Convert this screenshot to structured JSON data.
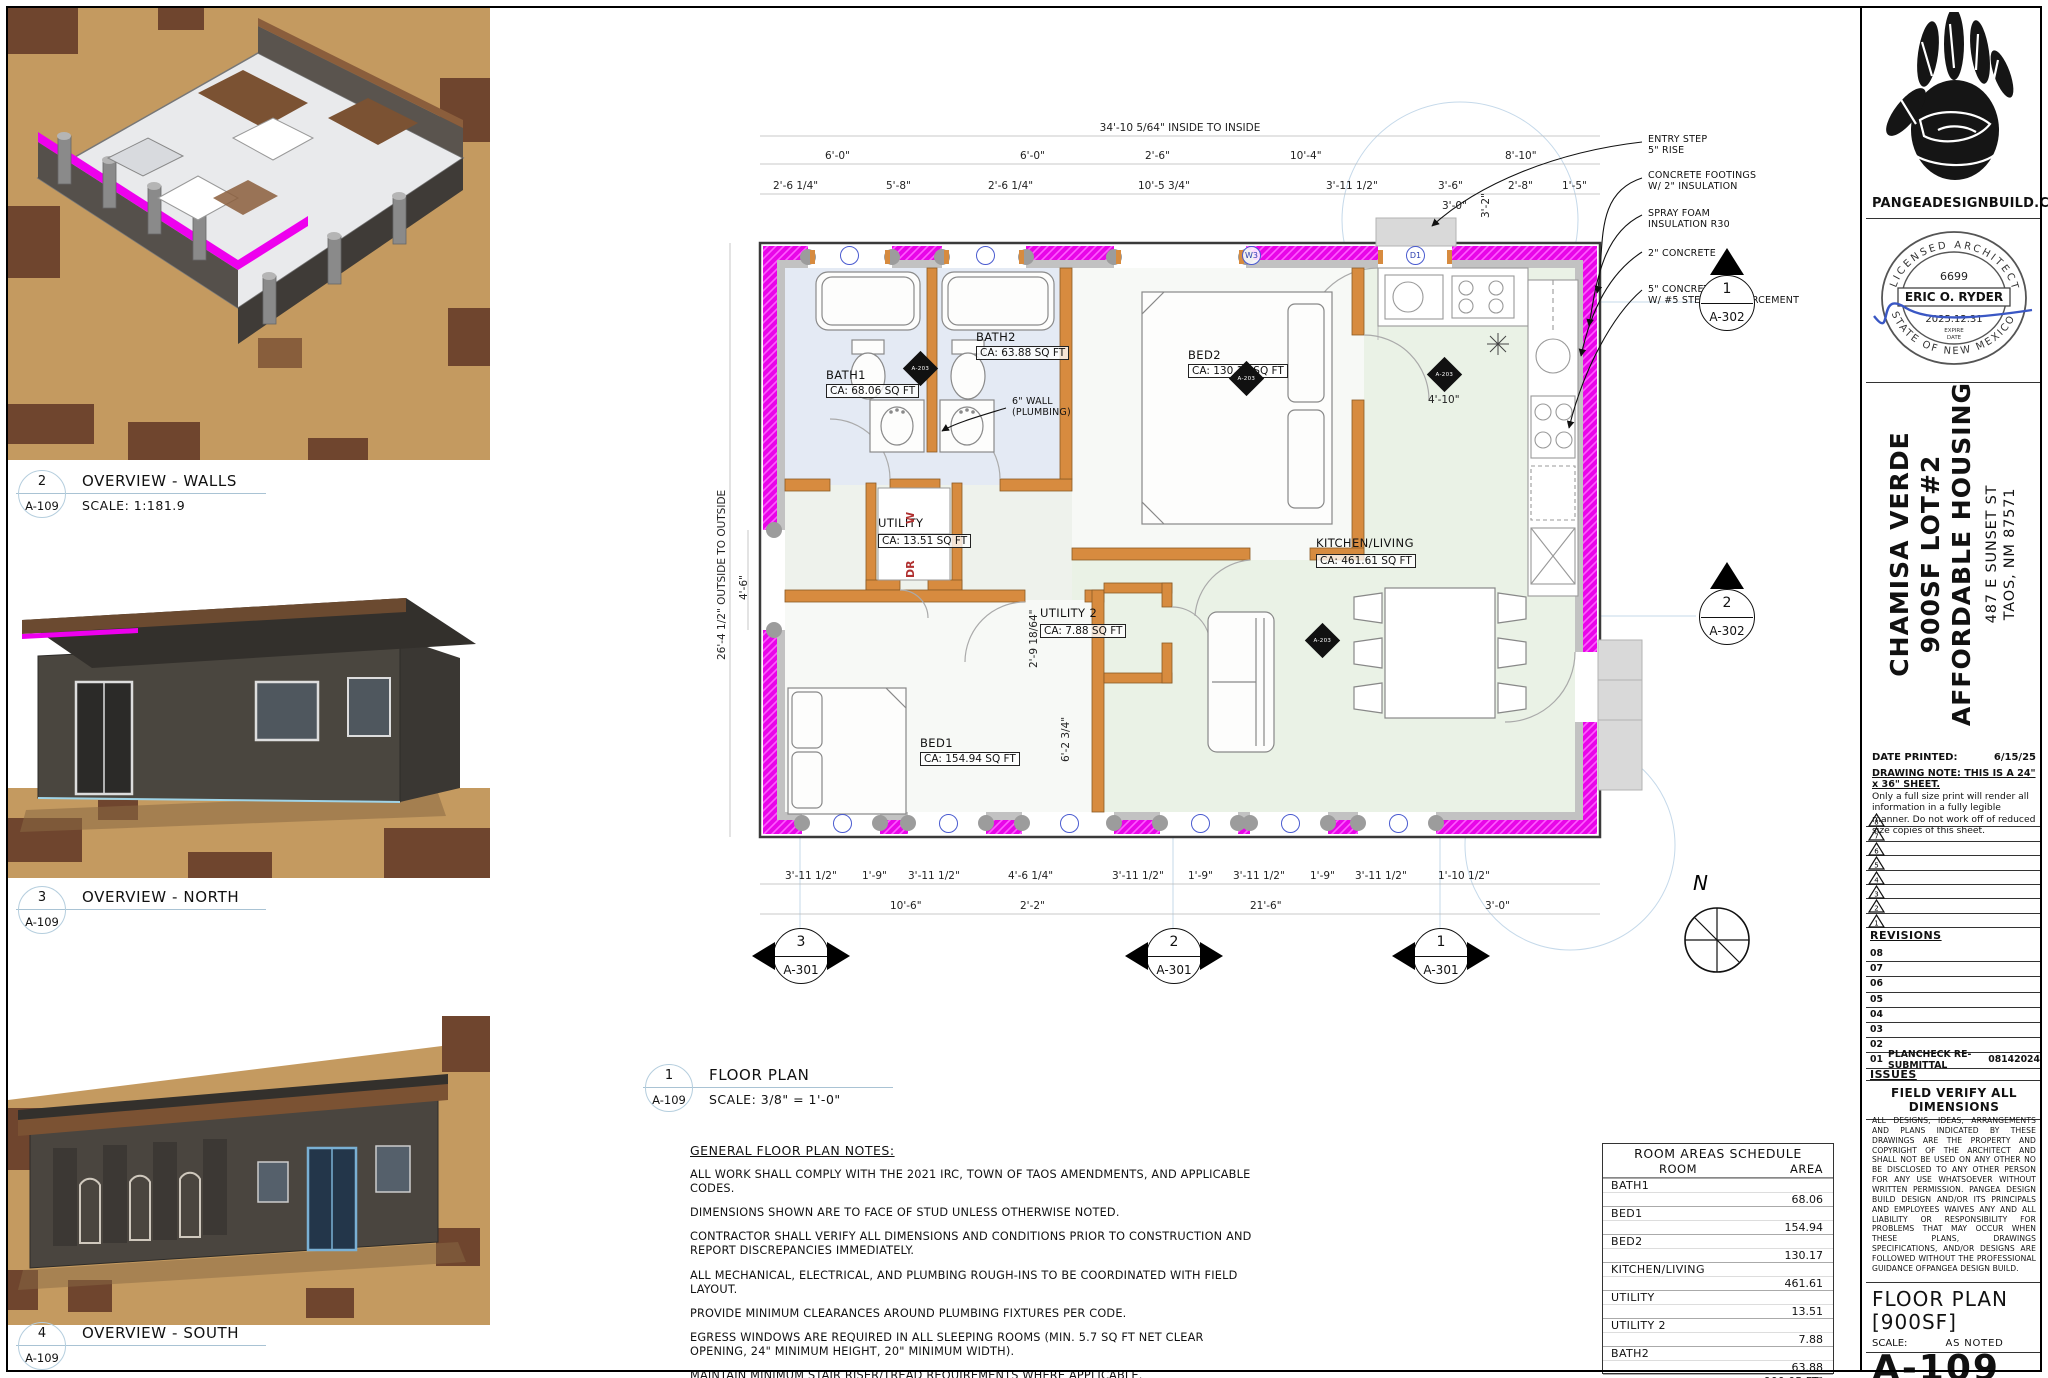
{
  "colors": {
    "insulation_magenta": "#EE00EE",
    "framing_orange": "#D78B3F",
    "tag_blue": "#4a5bd0",
    "signature_blue": "#3a57c4"
  },
  "view_labels": {
    "plan": {
      "num": "1",
      "ref": "A-109",
      "title": "FLOOR PLAN",
      "scale": "SCALE: 3/8\"  =  1'-0\""
    },
    "walls": {
      "num": "2",
      "ref": "A-109",
      "title": "OVERVIEW - WALLS",
      "scale": "SCALE: 1:181.9"
    },
    "north": {
      "num": "3",
      "ref": "A-109",
      "title": "OVERVIEW - NORTH"
    },
    "south": {
      "num": "4",
      "ref": "A-109",
      "title": "OVERVIEW - SOUTH"
    }
  },
  "plan": {
    "rooms": {
      "bath1_name": "BATH1",
      "bath1_area": "CA: 68.06 SQ FT",
      "bath2_name": "BATH2",
      "bath2_area": "CA: 63.88 SQ FT",
      "bed1_name": "BED1",
      "bed1_area": "CA: 154.94 SQ FT",
      "bed2_name": "BED2",
      "bed2_area": "CA: 130.17 SQ FT",
      "kitchen_name": "KITCHEN/LIVING",
      "kitchen_area": "CA: 461.61 SQ FT",
      "utility_name": "UTILITY",
      "utility_area": "CA: 13.51 SQ FT",
      "utility2_name": "UTILITY 2",
      "utility2_area": "CA: 7.88 SQ FT"
    },
    "washer": "W",
    "dryer": "DR",
    "wall_note1": "6\" WALL",
    "wall_note2": "(PLUMBING)",
    "callouts": [
      {
        "l1": "ENTRY STEP",
        "l2": "5\" RISE"
      },
      {
        "l1": "CONCRETE FOOTINGS",
        "l2": "W/ 2\" INSULATION"
      },
      {
        "l1": "SPRAY FOAM",
        "l2": "INSULATION R30"
      },
      {
        "l1": "2\" CONCRETE",
        "l2": ""
      },
      {
        "l1": "5\" CONCRETE WALL",
        "l2": "W/ #5 STEEL REINFORCEMENT"
      }
    ],
    "dim_overall_top": "34'-10 5/64\" INSIDE TO INSIDE",
    "dims_top_a": [
      "6'-0\"",
      "6'-0\"",
      "2'-6\"",
      "10'-4\"",
      "8'-10\""
    ],
    "dims_top_b": [
      "2'-6 1/4\"",
      "5'-8\"",
      "2'-6 1/4\"",
      "10'-5 3/4\"",
      "3'-11 1/2\"",
      "3'-6\"",
      "2'-8\"",
      "1'-5\""
    ],
    "dims_top_c": [
      "3'-2\"",
      "3'-0\""
    ],
    "dims_bottom_a": [
      "3'-11 1/2\"",
      "1'-9\"",
      "3'-11 1/2\"",
      "4'-6 1/4\"",
      "3'-11 1/2\"",
      "1'-9\"",
      "3'-11 1/2\"",
      "1'-9\"",
      "3'-11 1/2\"",
      "1'-10 1/2\""
    ],
    "dims_bottom_b": [
      "10'-6\"",
      "2'-2\"",
      "21'-6\"",
      "3'-0\""
    ],
    "dim_overall_left": "26'-4 1/2\" OUTSIDE TO OUTSIDE",
    "dim_left_a": "4'-6\"",
    "dims_inner": [
      "4'-10\"",
      "6'-2 3/4\"",
      "2'-9 18/64\""
    ],
    "tag_w3": "W3",
    "tag_d1": "D1",
    "detail_ref": "A-203",
    "markers": {
      "right1_num": "1",
      "right1_ref": "A-302",
      "right2_num": "2",
      "right2_ref": "A-302",
      "bottom": [
        {
          "num": "3",
          "ref": "A-301"
        },
        {
          "num": "2",
          "ref": "A-301"
        },
        {
          "num": "1",
          "ref": "A-301"
        }
      ]
    },
    "compass_label": "N"
  },
  "notes": {
    "heading": "GENERAL FLOOR PLAN NOTES:",
    "items": [
      "ALL WORK SHALL COMPLY WITH THE 2021 IRC, TOWN OF TAOS AMENDMENTS, AND APPLICABLE CODES.",
      "DIMENSIONS SHOWN ARE TO FACE OF STUD UNLESS OTHERWISE NOTED.",
      "CONTRACTOR SHALL VERIFY ALL DIMENSIONS AND CONDITIONS PRIOR TO CONSTRUCTION AND REPORT DISCREPANCIES IMMEDIATELY.",
      "ALL MECHANICAL, ELECTRICAL, AND PLUMBING ROUGH-INS TO BE COORDINATED WITH FIELD LAYOUT.",
      "PROVIDE MINIMUM CLEARANCES AROUND PLUMBING FIXTURES PER CODE.",
      "EGRESS WINDOWS ARE REQUIRED IN ALL SLEEPING ROOMS (MIN. 5.7 SQ FT NET CLEAR OPENING, 24\" MINIMUM HEIGHT, 20\" MINIMUM WIDTH).",
      "MAINTAIN MINIMUM STAIR RISER/TREAD REQUIREMENTS WHERE APPLICABLE.",
      "DO NOT SCALE DRAWINGS FOR CONSTRUCTION — USE WRITTEN DIMENSIONS ONLY."
    ]
  },
  "schedule": {
    "title": "ROOM AREAS SCHEDULE",
    "col_room": "ROOM",
    "col_area": "AREA",
    "rows": [
      {
        "room": "BATH1",
        "area": "68.06"
      },
      {
        "room": "BED1",
        "area": "154.94"
      },
      {
        "room": "BED2",
        "area": "130.17"
      },
      {
        "room": "KITCHEN/LIVING",
        "area": "461.61"
      },
      {
        "room": "UTILITY",
        "area": "13.51"
      },
      {
        "room": "UTILITY 2",
        "area": "7.88"
      },
      {
        "room": "BATH2",
        "area": "63.88"
      }
    ],
    "total": "900.05 FT²"
  },
  "titleblock": {
    "website": "PANGEADESIGNBUILD.COM",
    "stamp": {
      "arc_top": "LICENSED ARCHITECT",
      "license_no": "6699",
      "name": "ERIC O. RYDER",
      "expire_date": "2025.12.31",
      "expire_label": "EXPIRE",
      "date_label": "DATE",
      "arc_bottom": "STATE OF NEW MEXICO"
    },
    "project": {
      "line1": "CHAMISA VERDE",
      "line2": "900SF LOT#2",
      "line3": "AFFORDABLE HOUSING",
      "addr1": "487 E SUNSET ST",
      "addr2": "TAOS, NM 87571"
    },
    "date_printed_label": "DATE PRINTED:",
    "date_printed": "6/15/25",
    "drawing_note_title": "DRAWING NOTE: THIS IS A 24\" x 36\" SHEET.",
    "drawing_note_body": "Only a full size print will render all information in a fully legible manner. Do not work off of reduced size copies of this sheet.",
    "revision_triangles": [
      "8",
      "7",
      "6",
      "5",
      "4",
      "3",
      "2",
      "1"
    ],
    "revisions_label": "REVISIONS",
    "issue_rows": [
      {
        "num": "08",
        "desc": "",
        "date": ""
      },
      {
        "num": "07",
        "desc": "",
        "date": ""
      },
      {
        "num": "06",
        "desc": "",
        "date": ""
      },
      {
        "num": "05",
        "desc": "",
        "date": ""
      },
      {
        "num": "04",
        "desc": "",
        "date": ""
      },
      {
        "num": "03",
        "desc": "",
        "date": ""
      },
      {
        "num": "02",
        "desc": "",
        "date": ""
      },
      {
        "num": "01",
        "desc": "PLANCHECK RE-SUBMITTAL",
        "date": "08142024"
      }
    ],
    "issues_label": "ISSUES",
    "field_verify": "FIELD VERIFY ALL DIMENSIONS",
    "legal": "ALL DESIGNS, IDEAS, ARRANGEMENTS AND PLANS INDICATED BY THESE DRAWINGS ARE THE PROPERTY AND COPYRIGHT OF THE ARCHITECT AND SHALL NOT BE USED ON ANY OTHER NO BE DISCLOSED TO ANY OTHER PERSON FOR ANY USE WHATSOEVER WITHOUT WRITTEN PERMISSION. PANGEA DESIGN BUILD DESIGN AND/OR ITS PRINCIPALS AND EMPLOYEES WAIVES ANY AND ALL LIABILITY OR RESPONSIBILITY FOR PROBLEMS THAT MAY OCCUR WHEN THESE PLANS, DRAWINGS SPECIFICATIONS, AND/OR DESIGNS ARE FOLLOWED WITHOUT THE PROFESSIONAL GUIDANCE OFPANGEA DESIGN BUILD.",
    "sheet_title1": "FLOOR PLAN",
    "sheet_title2": "[900SF]",
    "scale_label": "SCALE:",
    "scale_value": "AS NOTED",
    "sheet_number": "A-109"
  }
}
